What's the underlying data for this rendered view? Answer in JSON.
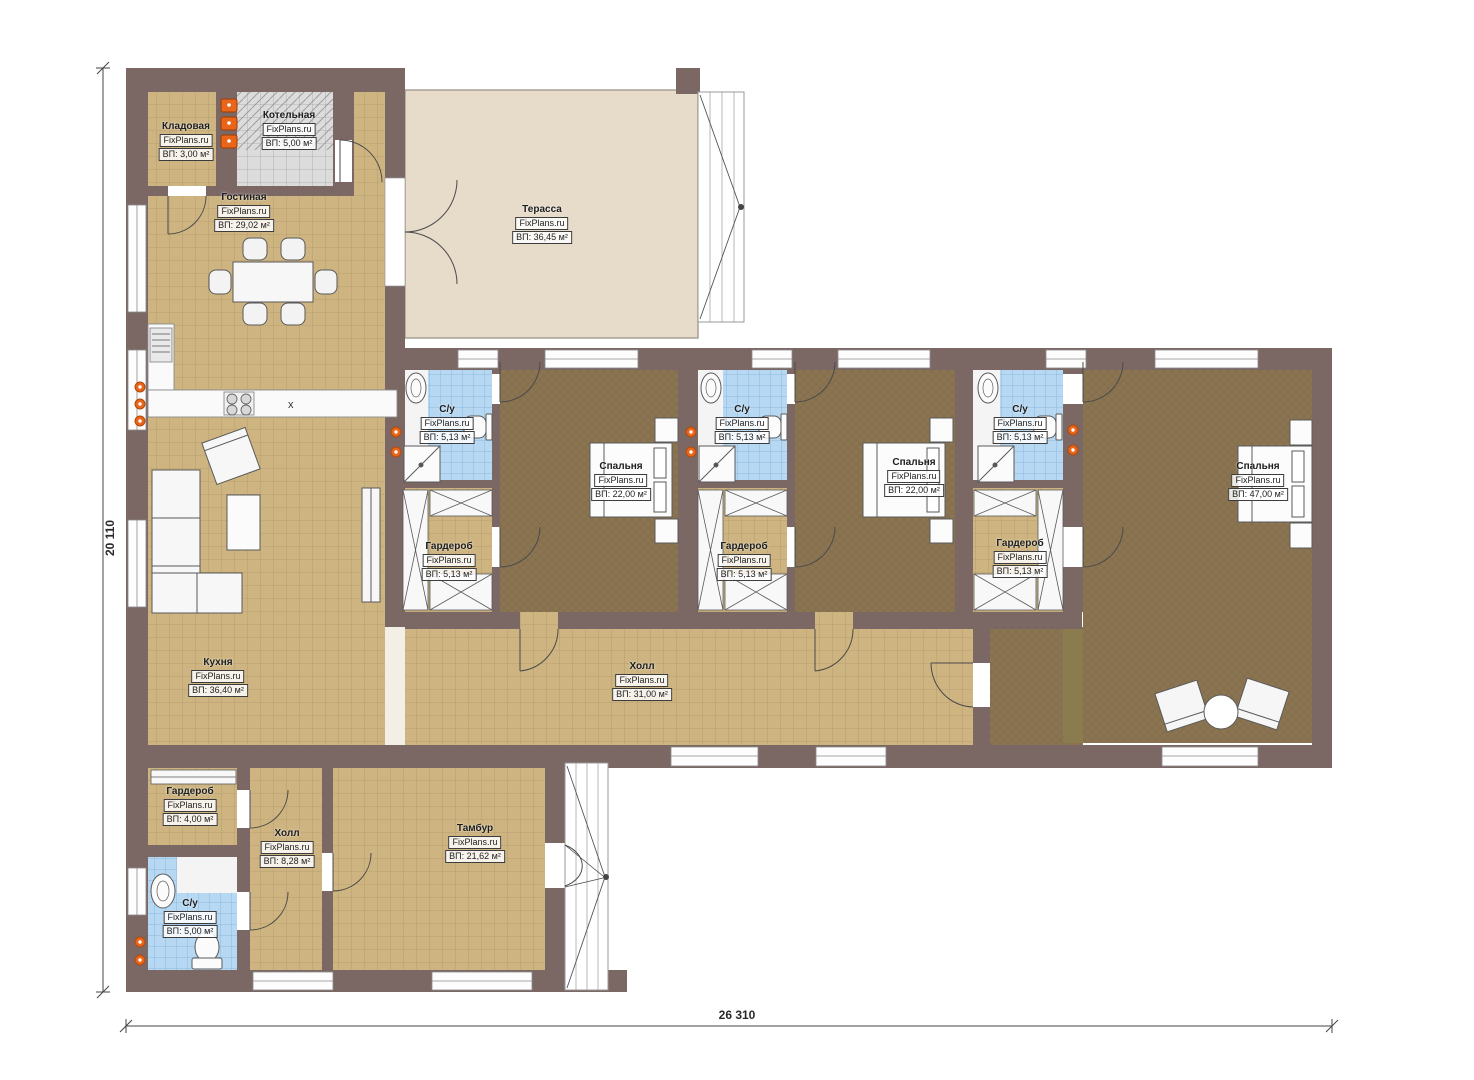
{
  "watermark": "FixPlans.ru",
  "dimensions": {
    "total_width": "26 310",
    "total_height": "20 110"
  },
  "rooms": [
    {
      "id": "kladovaya",
      "name": "Кладовая",
      "area": "ВП: 3,00 м²"
    },
    {
      "id": "kotelnaya",
      "name": "Котельная",
      "area": "ВП: 5,00 м²"
    },
    {
      "id": "gostinaya",
      "name": "Гостиная",
      "area": "ВП: 29,02 м²"
    },
    {
      "id": "terrasa",
      "name": "Терасса",
      "area": "ВП: 36,45 м²"
    },
    {
      "id": "su-1",
      "name": "С/у",
      "area": "ВП: 5,13 м²"
    },
    {
      "id": "garderob-1",
      "name": "Гардероб",
      "area": "ВП: 5,13 м²"
    },
    {
      "id": "spalnya-1",
      "name": "Спальня",
      "area": "ВП: 22,00 м²"
    },
    {
      "id": "su-2",
      "name": "С/у",
      "area": "ВП: 5,13 м²"
    },
    {
      "id": "garderob-2",
      "name": "Гардероб",
      "area": "ВП: 5,13 м²"
    },
    {
      "id": "spalnya-2",
      "name": "Спальня",
      "area": "ВП: 22,00 м²"
    },
    {
      "id": "su-3",
      "name": "С/у",
      "area": "ВП: 5,13 м²"
    },
    {
      "id": "garderob-3",
      "name": "Гардероб",
      "area": "ВП: 5,13 м²"
    },
    {
      "id": "spalnya-master",
      "name": "Спальня",
      "area": "ВП: 47,00 м²"
    },
    {
      "id": "kuhnya",
      "name": "Кухня",
      "area": "ВП: 36,40 м²"
    },
    {
      "id": "holl-main",
      "name": "Холл",
      "area": "ВП: 31,00 м²"
    },
    {
      "id": "garderob-entry",
      "name": "Гардероб",
      "area": "ВП: 4,00 м²"
    },
    {
      "id": "holl-entry",
      "name": "Холл",
      "area": "ВП: 8,28 м²"
    },
    {
      "id": "tambur",
      "name": "Тамбур",
      "area": "ВП: 21,62 м²"
    },
    {
      "id": "su-entry",
      "name": "С/у",
      "area": "ВП: 5,00 м²"
    }
  ],
  "colors": {
    "wall": "#7b6865",
    "tile_floor": "#cdb480",
    "carpet_floor": "#8b7452",
    "terrace_floor": "#e7dbc9",
    "wet_tile": "#b7d8f3",
    "boiler_tile": "#dcdcdc",
    "radiator": "#e8651a",
    "wardrobe_band": "#8a7c4e"
  }
}
